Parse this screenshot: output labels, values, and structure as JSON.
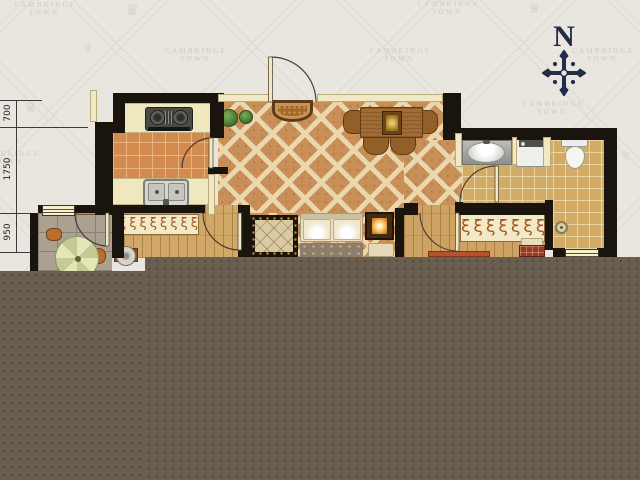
{
  "compass": {
    "label": "N"
  },
  "dimensions": {
    "items": [
      {
        "label": "700"
      },
      {
        "label": "1750"
      },
      {
        "label": "950"
      }
    ]
  },
  "watermark": {
    "line1": "CAMBRIDGE",
    "line2": "TOWN",
    "crown": "♛",
    "fleur": "⚜"
  },
  "wardrobes": {
    "glyphs_small": "ξξξξξξξξξ",
    "glyphs_large": "ξξξξξξξξξξξ"
  },
  "colors": {
    "occluder": "#695e50",
    "wall": "#1a140e",
    "cream_wall": "#f0e9c4",
    "compass_navy": "#232c49",
    "diag_tile": "#c89058",
    "kitchen_tile": "#d28a4e",
    "bath_tile": "#d2ab67",
    "wood_floor": "#d2a868",
    "balcony_tile": "#aaa192"
  }
}
